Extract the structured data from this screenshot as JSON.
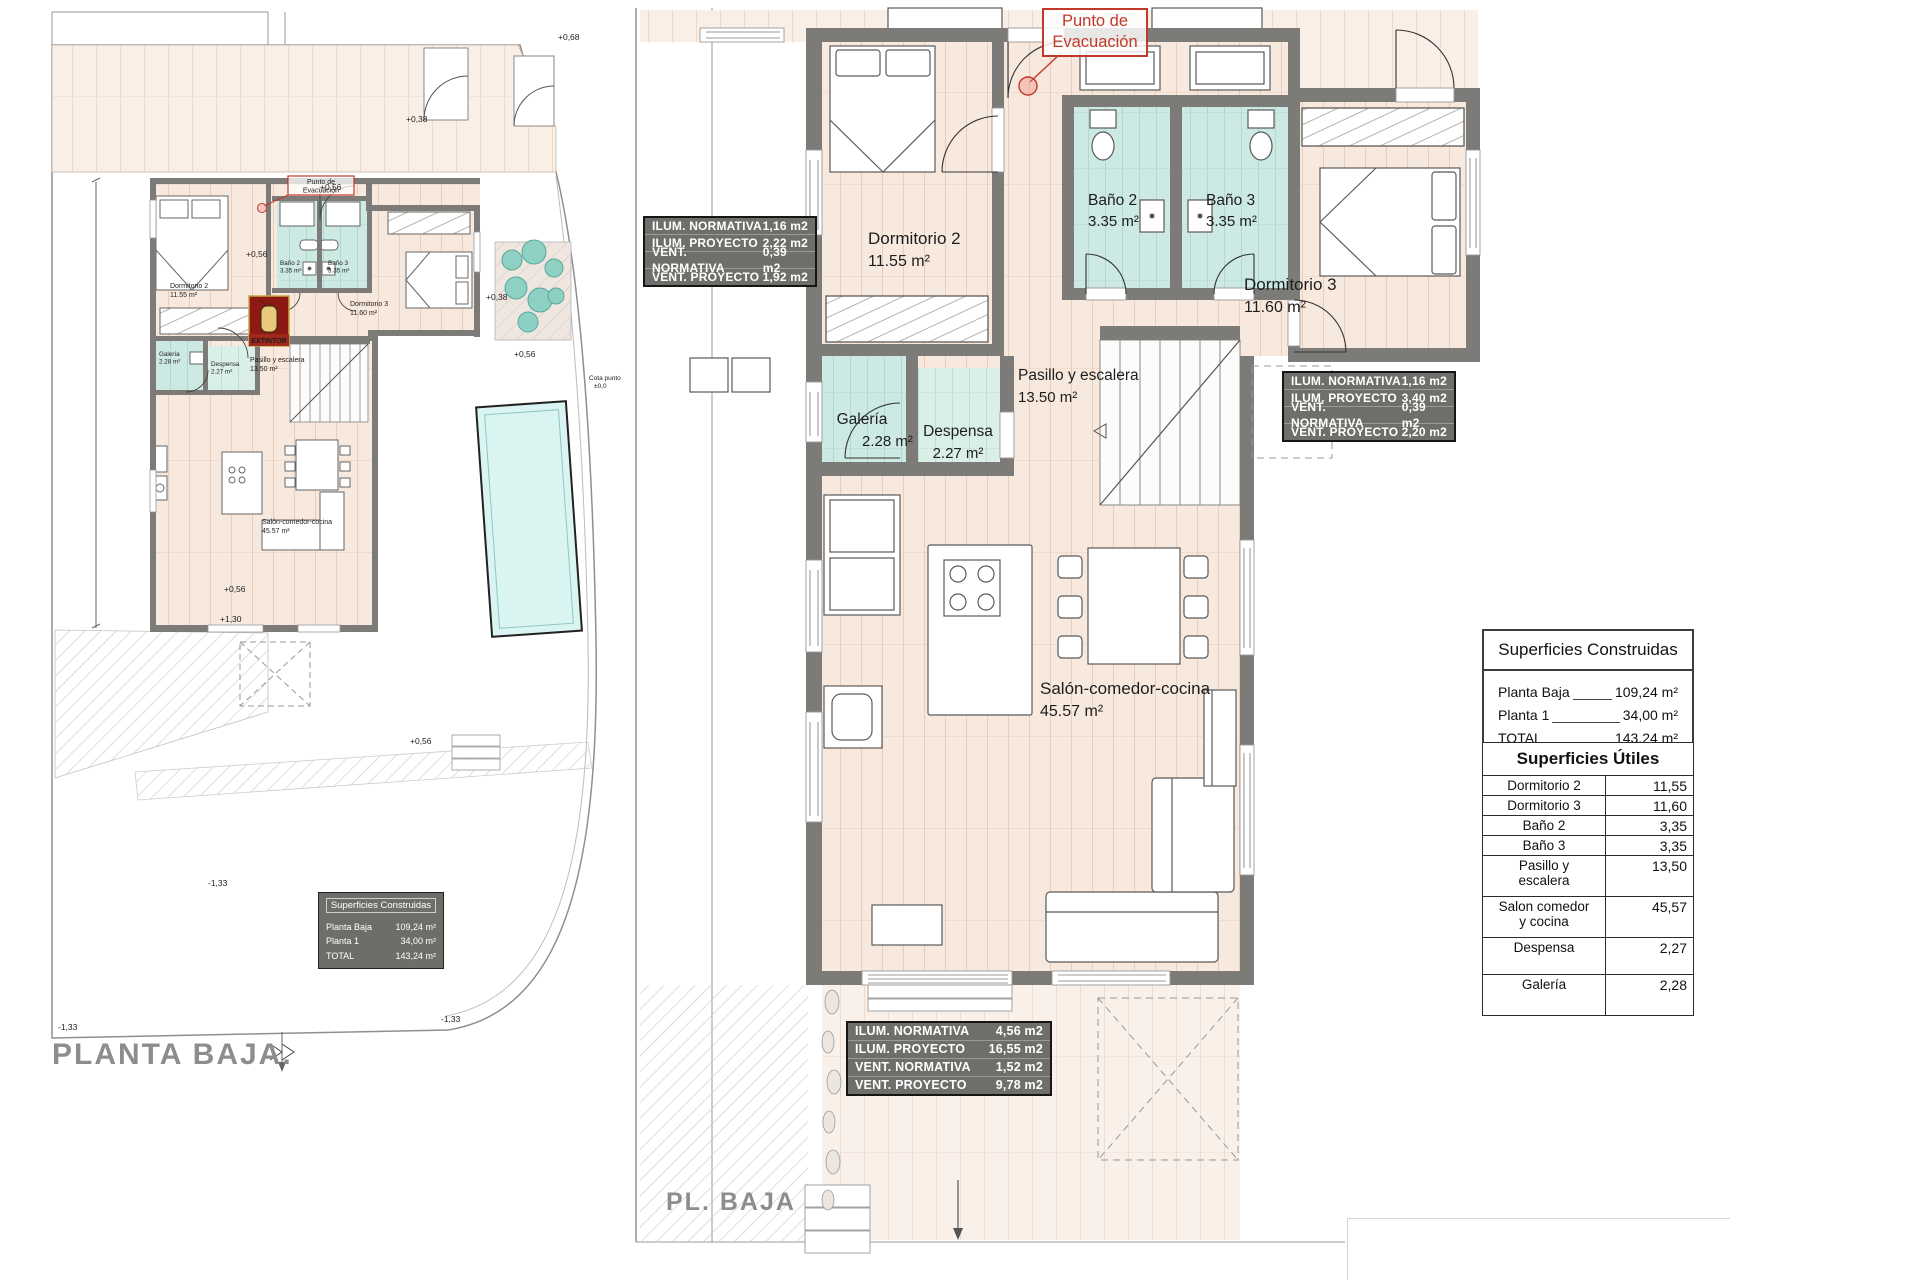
{
  "colors": {
    "wall": "#7c7b77",
    "floor": "#f8e9de",
    "floor_terrace": "#f9efe7",
    "teal_room": "#cde9e3",
    "pool": "#d9f4f1",
    "evacuation_red": "#c0392b",
    "table_dark_bg": "#6f6e6a",
    "title_gray": "#8d8d8d"
  },
  "left_plan": {
    "title": "PLANTA BAJA.",
    "evacuation": {
      "line1": "Punto de",
      "line2": "Evacuación"
    },
    "extintor_label": "EXTINTOR",
    "cota": {
      "line1": "Cota punto",
      "line2": "±0,0"
    },
    "rooms": [
      {
        "name": "Dormitorio 2",
        "area": "11.55 m²"
      },
      {
        "name": "Baño 2",
        "area": "3.35 m²"
      },
      {
        "name": "Baño 3",
        "area": "3.35 m²"
      },
      {
        "name": "Dormitorio 3",
        "area": "11.60 m²"
      },
      {
        "name": "Galería",
        "area": "2.28 m²"
      },
      {
        "name": "Despensa",
        "area": "2.27 m²"
      },
      {
        "name": "Pasillo y escalera",
        "area": "13.50 m²"
      },
      {
        "name": "Salón-comedor-cocina",
        "area": "45.57 m²"
      }
    ],
    "elevations": [
      "+0,68",
      "+0,38",
      "+0,56",
      "+0,56",
      "+0,38",
      "+0,56",
      "+0,56",
      "+1,30",
      "+0,56",
      "-1,33",
      "-1,33",
      "-1,33"
    ],
    "superficies_box": {
      "title": "Superficies Construidas",
      "rows": [
        {
          "label": "Planta Baja",
          "value": "109,24 m²"
        },
        {
          "label": "Planta 1",
          "value": "34,00 m²"
        },
        {
          "label": "TOTAL",
          "value": "143,24 m²"
        }
      ]
    }
  },
  "right_plan": {
    "title": "PL. BAJA",
    "evacuation": {
      "line1": "Punto de",
      "line2": "Evacuación"
    },
    "rooms": [
      {
        "name": "Dormitorio 2",
        "area": "11.55 m²"
      },
      {
        "name": "Baño 2",
        "area": "3.35 m²"
      },
      {
        "name": "Baño 3",
        "area": "3.35 m²"
      },
      {
        "name": "Dormitorio 3",
        "area": "11.60 m²"
      },
      {
        "name": "Galería",
        "area": "2.28 m²"
      },
      {
        "name": "Despensa",
        "area": "2.27 m²"
      },
      {
        "name": "Pasillo y escalera",
        "area": "13.50 m²"
      },
      {
        "name": "Salón-comedor-cocina",
        "area": "45.57 m²"
      }
    ],
    "ilum_tables": [
      {
        "rows": [
          [
            "ILUM. NORMATIVA",
            "1,16 m2"
          ],
          [
            "ILUM. PROYECTO",
            "2,22 m2"
          ],
          [
            "VENT. NORMATIVA",
            "0,39 m2"
          ],
          [
            "VENT. PROYECTO",
            "1,92 m2"
          ]
        ]
      },
      {
        "rows": [
          [
            "ILUM. NORMATIVA",
            "1,16 m2"
          ],
          [
            "ILUM. PROYECTO",
            "3,40 m2"
          ],
          [
            "VENT. NORMATIVA",
            "0,39 m2"
          ],
          [
            "VENT. PROYECTO",
            "2,20 m2"
          ]
        ]
      },
      {
        "rows": [
          [
            "ILUM. NORMATIVA",
            "4,56 m2"
          ],
          [
            "ILUM. PROYECTO",
            "16,55 m2"
          ],
          [
            "VENT. NORMATIVA",
            "1,52 m2"
          ],
          [
            "VENT. PROYECTO",
            "9,78 m2"
          ]
        ]
      }
    ]
  },
  "summary_tables": {
    "construidas": {
      "title": "Superficies Construidas",
      "rows": [
        {
          "label": "Planta Baja",
          "value": "109,24 m²"
        },
        {
          "label": "Planta 1",
          "value": "34,00 m²"
        },
        {
          "label": "TOTAL",
          "value": "143,24 m²"
        }
      ]
    },
    "utiles": {
      "title": "Superficies Útiles",
      "rows": [
        {
          "label": "Dormitorio 2",
          "value": "11,55"
        },
        {
          "label": "Dormitorio 3",
          "value": "11,60"
        },
        {
          "label": "Baño 2",
          "value": "3,35"
        },
        {
          "label": "Baño 3",
          "value": "3,35"
        },
        {
          "label": "Pasillo y\nescalera",
          "value": "13,50"
        },
        {
          "label": "Salon comedor\ny cocina",
          "value": "45,57"
        },
        {
          "label": "Despensa",
          "value": "2,27"
        },
        {
          "label": "Galería",
          "value": "2,28"
        }
      ]
    }
  }
}
